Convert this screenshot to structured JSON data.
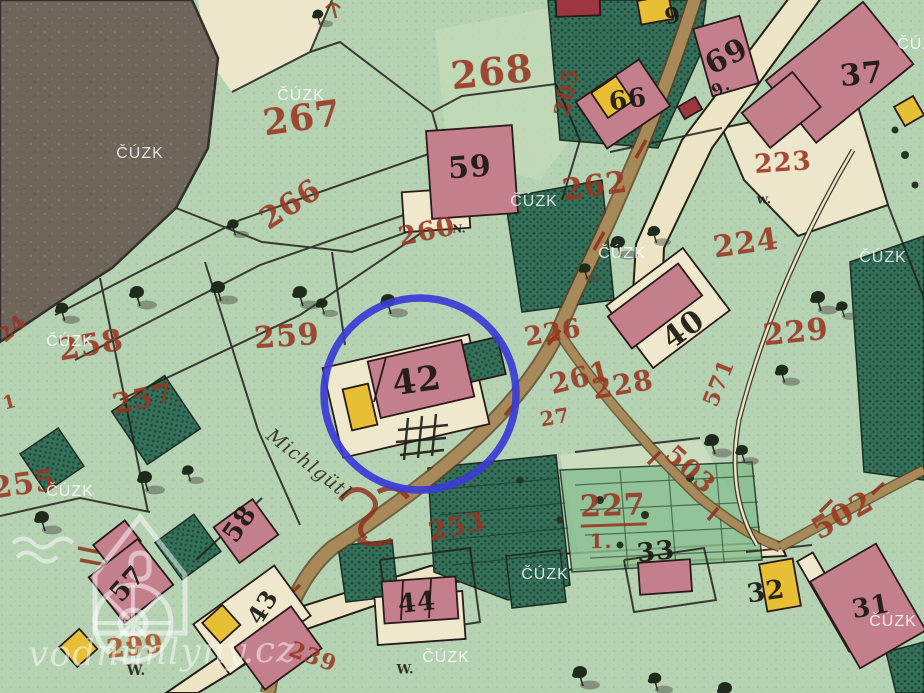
{
  "map_type": "historic cadastral map scan",
  "watermarks": {
    "agency": "ČÚZK",
    "site": "vodnimlyny.cz"
  },
  "cuzk_watermarks": [
    {
      "x": 140,
      "y": 154
    },
    {
      "x": 301,
      "y": 96
    },
    {
      "x": 534,
      "y": 202
    },
    {
      "x": 622,
      "y": 254
    },
    {
      "x": 883,
      "y": 258
    },
    {
      "x": 70,
      "y": 342
    },
    {
      "x": 70,
      "y": 492
    },
    {
      "x": 545,
      "y": 575
    },
    {
      "x": 446,
      "y": 658
    },
    {
      "x": 893,
      "y": 622
    },
    {
      "x": 921,
      "y": 45
    }
  ],
  "parcel_labels": [
    {
      "text": "268",
      "x": 492,
      "y": 72,
      "rot": -6,
      "size": 38
    },
    {
      "text": "267",
      "x": 302,
      "y": 118,
      "rot": -8,
      "size": 36
    },
    {
      "text": "266",
      "x": 291,
      "y": 205,
      "rot": -33,
      "size": 30
    },
    {
      "text": "260",
      "x": 427,
      "y": 232,
      "rot": -12,
      "size": 26
    },
    {
      "text": "262",
      "x": 595,
      "y": 187,
      "rot": -8,
      "size": 30
    },
    {
      "text": "223",
      "x": 783,
      "y": 163,
      "rot": -4,
      "size": 26
    },
    {
      "text": "224",
      "x": 746,
      "y": 244,
      "rot": -8,
      "size": 30
    },
    {
      "text": "229",
      "x": 796,
      "y": 333,
      "rot": -6,
      "size": 30
    },
    {
      "text": "259",
      "x": 287,
      "y": 337,
      "rot": -4,
      "size": 30
    },
    {
      "text": "258",
      "x": 91,
      "y": 346,
      "rot": -10,
      "size": 30
    },
    {
      "text": "257",
      "x": 143,
      "y": 399,
      "rot": -12,
      "size": 28
    },
    {
      "text": "255",
      "x": 24,
      "y": 485,
      "rot": -8,
      "size": 30
    },
    {
      "text": "226",
      "x": 553,
      "y": 333,
      "rot": -10,
      "size": 26
    },
    {
      "text": "228",
      "x": 623,
      "y": 385,
      "rot": -10,
      "size": 28
    },
    {
      "text": "261",
      "x": 580,
      "y": 378,
      "rot": -14,
      "size": 28
    },
    {
      "text": "27",
      "x": 555,
      "y": 417,
      "rot": -10,
      "size": 20
    },
    {
      "text": "227",
      "x": 613,
      "y": 509,
      "rot": -2,
      "size": 30,
      "underline": true
    },
    {
      "text": "1.",
      "x": 601,
      "y": 541,
      "rot": 0,
      "size": 20
    },
    {
      "text": "571",
      "x": 719,
      "y": 383,
      "rot": -68,
      "size": 22
    },
    {
      "text": "503",
      "x": 690,
      "y": 470,
      "rot": 42,
      "size": 26
    },
    {
      "text": "502",
      "x": 843,
      "y": 516,
      "rot": -30,
      "size": 30
    },
    {
      "text": "253",
      "x": 457,
      "y": 527,
      "rot": -12,
      "size": 26
    },
    {
      "text": "299",
      "x": 135,
      "y": 647,
      "rot": -6,
      "size": 26,
      "orange": true
    },
    {
      "text": "239",
      "x": 313,
      "y": 657,
      "rot": 20,
      "size": 22
    },
    {
      "text": "205",
      "x": 567,
      "y": 92,
      "rot": -78,
      "size": 22
    },
    {
      "text": "24",
      "x": 12,
      "y": 328,
      "rot": -40,
      "size": 20
    },
    {
      "text": "1",
      "x": 10,
      "y": 403,
      "rot": -15,
      "size": 18
    }
  ],
  "building_labels": [
    {
      "text": "59",
      "x": 470,
      "y": 168,
      "rot": -4,
      "size": 30
    },
    {
      "text": "69",
      "x": 727,
      "y": 57,
      "rot": -28,
      "size": 30
    },
    {
      "text": "9.",
      "x": 721,
      "y": 88,
      "rot": -28,
      "size": 16
    },
    {
      "text": "66",
      "x": 628,
      "y": 100,
      "rot": -8,
      "size": 26
    },
    {
      "text": "9",
      "x": 673,
      "y": 16,
      "rot": -12,
      "size": 22
    },
    {
      "text": "37",
      "x": 862,
      "y": 75,
      "rot": -6,
      "size": 30
    },
    {
      "text": "40",
      "x": 684,
      "y": 330,
      "rot": -36,
      "size": 30
    },
    {
      "text": "42",
      "x": 417,
      "y": 381,
      "rot": -8,
      "size": 34
    },
    {
      "text": "58",
      "x": 240,
      "y": 524,
      "rot": -55,
      "size": 26
    },
    {
      "text": "57",
      "x": 128,
      "y": 584,
      "rot": -48,
      "size": 26
    },
    {
      "text": "43",
      "x": 263,
      "y": 607,
      "rot": -58,
      "size": 24
    },
    {
      "text": "44",
      "x": 417,
      "y": 603,
      "rot": -6,
      "size": 26
    },
    {
      "text": "33",
      "x": 656,
      "y": 552,
      "rot": -6,
      "size": 26
    },
    {
      "text": "32",
      "x": 766,
      "y": 592,
      "rot": -8,
      "size": 26
    },
    {
      "text": "31",
      "x": 871,
      "y": 607,
      "rot": -10,
      "size": 26
    }
  ],
  "survey_marks": [
    {
      "text": "N.",
      "x": 459,
      "y": 229,
      "size": 11
    },
    {
      "text": "w.",
      "x": 764,
      "y": 200,
      "size": 13
    },
    {
      "text": "W.",
      "x": 136,
      "y": 671,
      "size": 14
    },
    {
      "text": "W.",
      "x": 405,
      "y": 670,
      "size": 13
    }
  ],
  "place_label": {
    "text": "Michlgütl"
  },
  "highlight": {
    "type": "circle",
    "cx": 420,
    "cy": 394,
    "r": 96,
    "stroke_width": 7.5,
    "color": "#3b3bd6"
  },
  "palette": {
    "green_base": "#b5d2b2",
    "green_light": "#c7dcba",
    "green_pale": "#cfe0c0",
    "cream": "#efe8cc",
    "cream_road": "#ece4c4",
    "dark_blob": "#6e655b",
    "blob_speck": "#8a8175",
    "teal": "#35705a",
    "teal_dark": "#1f4a38",
    "garden_mid": "#8abf92",
    "pink": "#c47f8d",
    "darkred": "#9e3640",
    "yellow": "#e6bf35",
    "road_tan": "#a8895a",
    "road_edge": "#5d4326",
    "red_dash": "#8c2f1a",
    "label_red": "#993522",
    "label_orange": "#b05327",
    "label_black": "#1b1711",
    "boundary": "#23201a",
    "tree_dark": "#1f2c1c",
    "shadow": "rgba(70,70,65,0.45)",
    "watermark": "rgba(255,255,255,0.82)",
    "site_wm": "rgba(255,255,255,0.5)"
  }
}
